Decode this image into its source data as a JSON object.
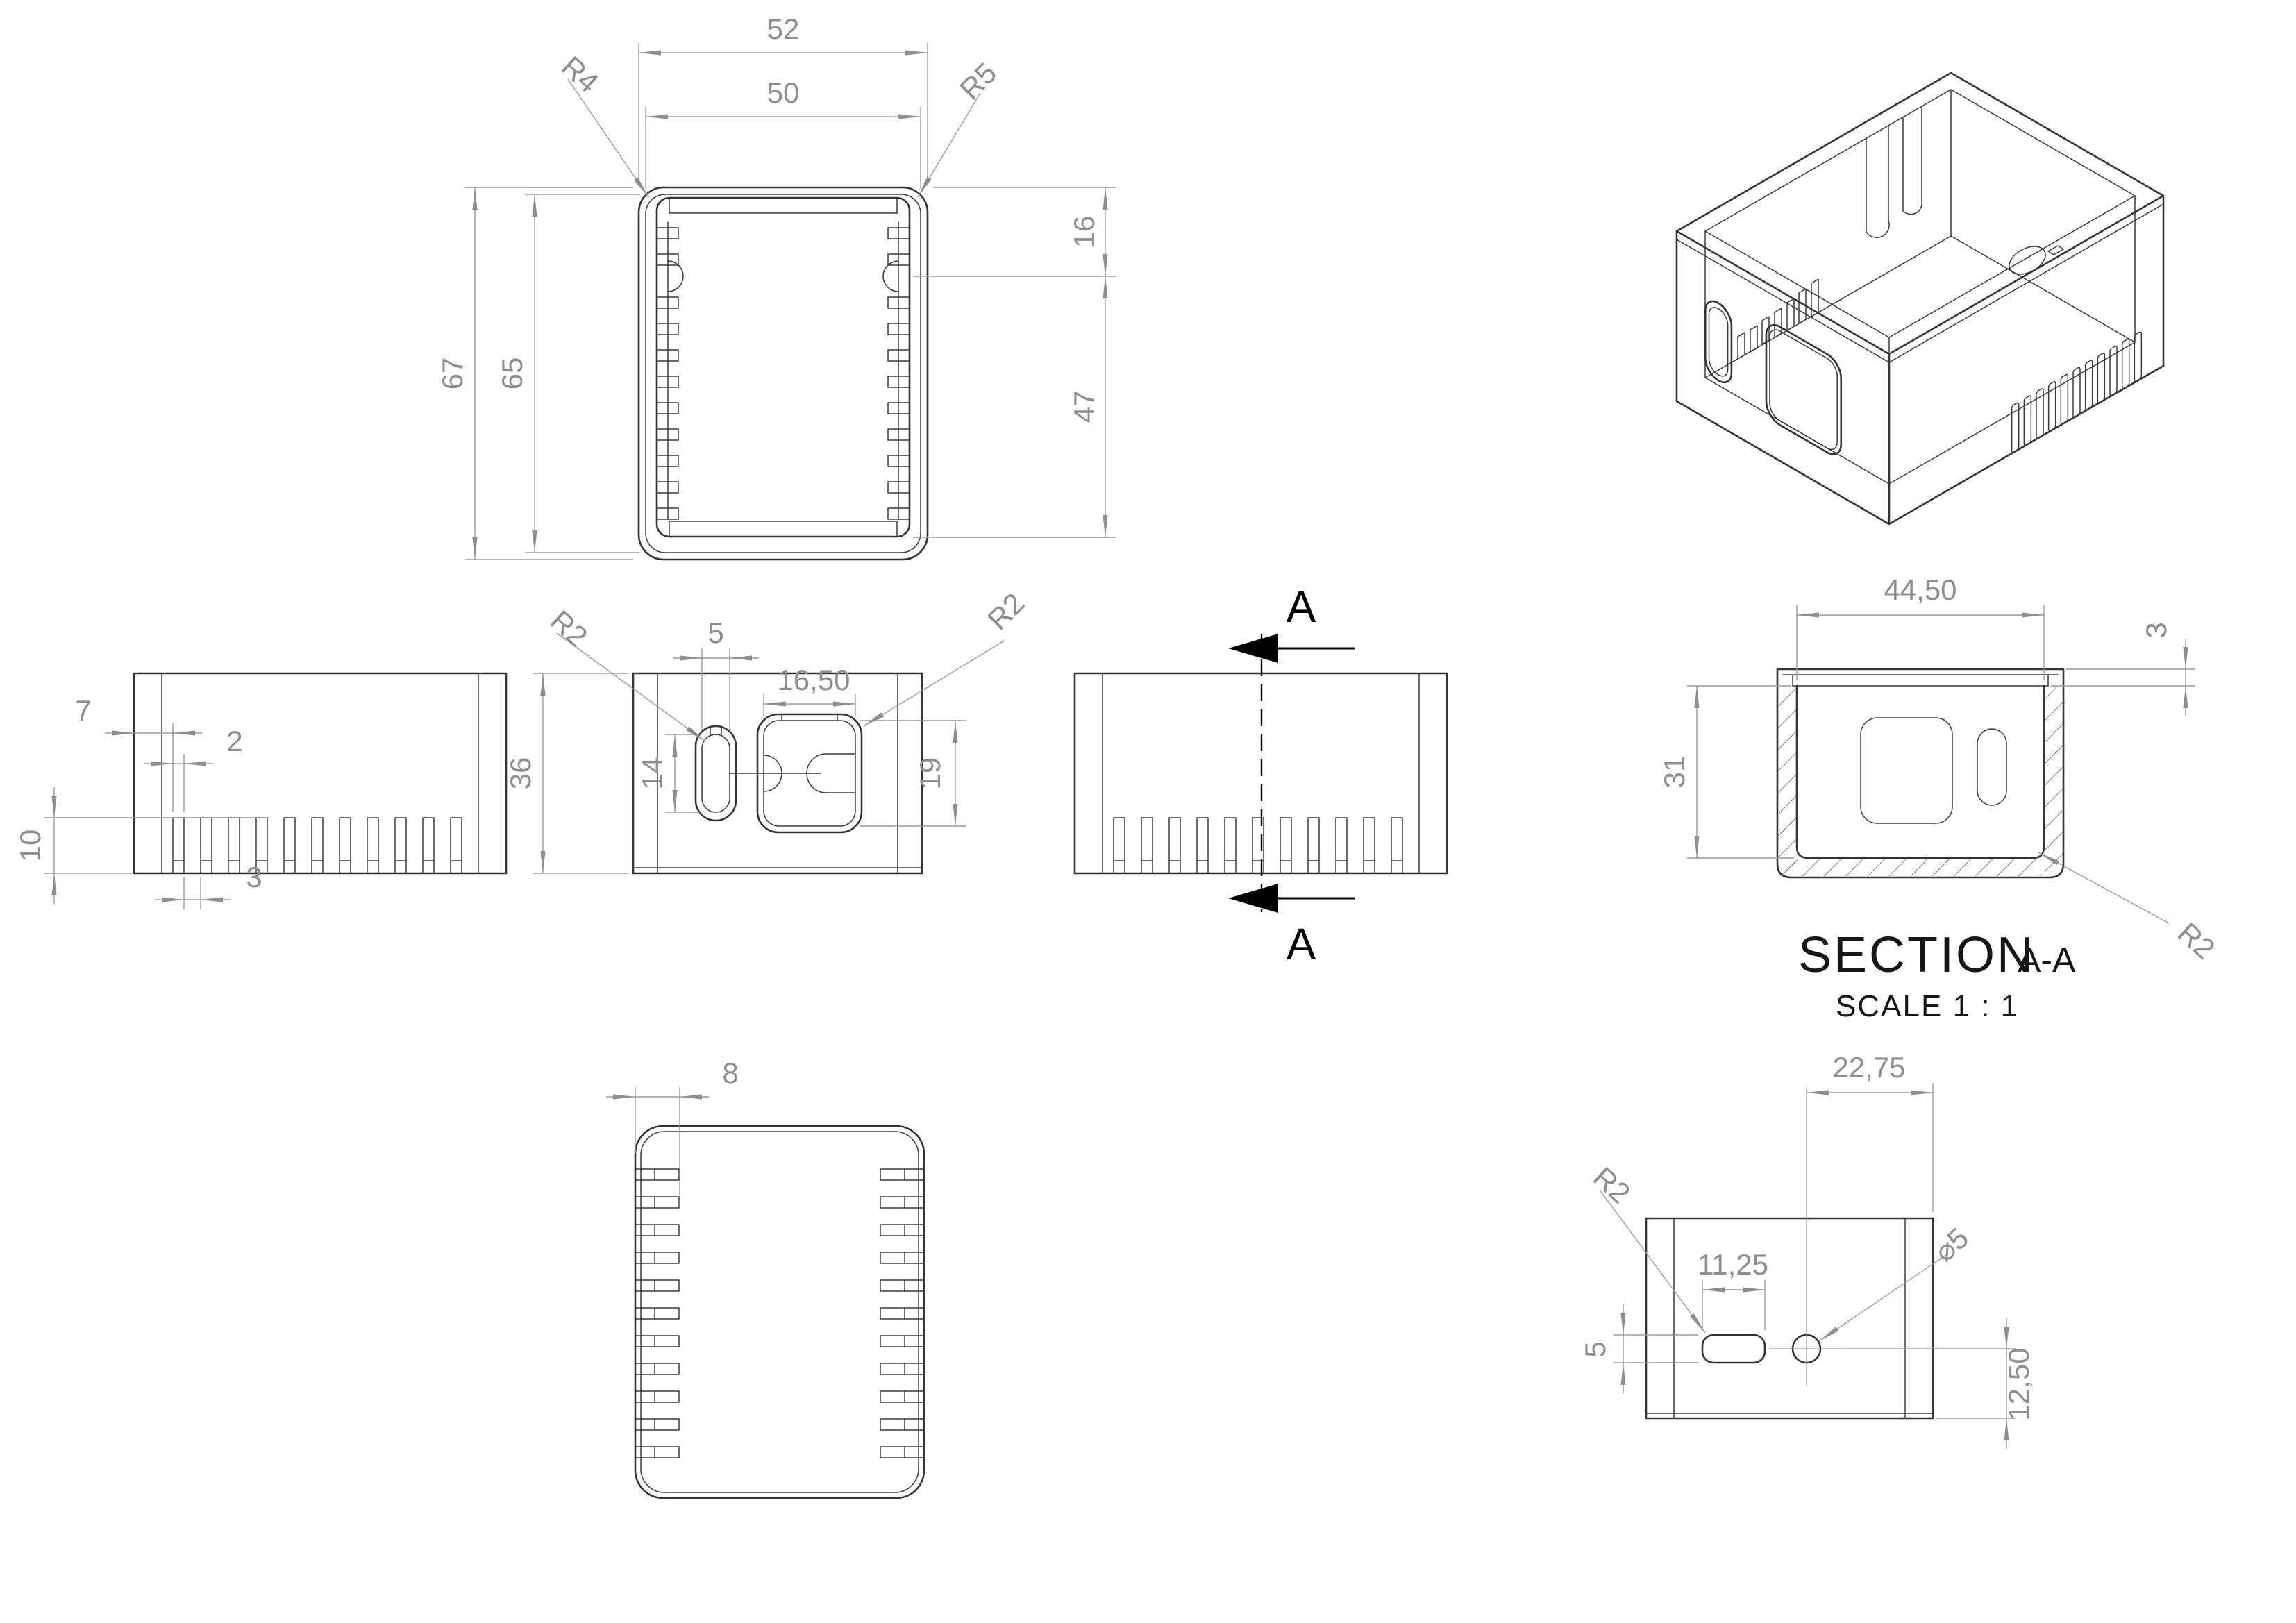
{
  "palette": {
    "geometry_line": "#343434",
    "dimension_line": "#9c9c9c",
    "dimension_text": "#8e8e8e",
    "annotation": "#000000",
    "background": "#ffffff"
  },
  "views": {
    "top": {
      "dims": {
        "outer_width": "52",
        "inner_width": "50",
        "corner_left": "R4",
        "corner_right": "R5",
        "outer_height": "67",
        "inner_height": "65",
        "rim_offset": "16",
        "body_depth": "47"
      }
    },
    "left_side": {
      "dims": {
        "slot_offset": "7",
        "slot_width": "2",
        "slot_height": "10",
        "slot_gap": "3"
      }
    },
    "front": {
      "dims": {
        "corner_left": "R2",
        "oval_width": "5",
        "cutout_width": "16,50",
        "corner_right": "R2",
        "height": "36",
        "oval_height": "14",
        "cutout_height": "19"
      }
    },
    "right_side": {
      "section_label_top": "A",
      "section_label_bottom": "A"
    },
    "section": {
      "dims": {
        "inner_width": "44,50",
        "lip_height": "3",
        "inner_depth": "31",
        "corner": "R2"
      },
      "title": "SECTION",
      "title_ref": "A-A",
      "scale_note": "SCALE 1 : 1"
    },
    "bottom": {
      "dims": {
        "slot_depth": "8"
      }
    },
    "back": {
      "dims": {
        "hole_offset_x": "22,75",
        "corner": "R2",
        "slot_length": "11,25",
        "hole_diameter": "⌀5",
        "slot_height": "5",
        "hole_offset_y": "12,50"
      }
    }
  }
}
